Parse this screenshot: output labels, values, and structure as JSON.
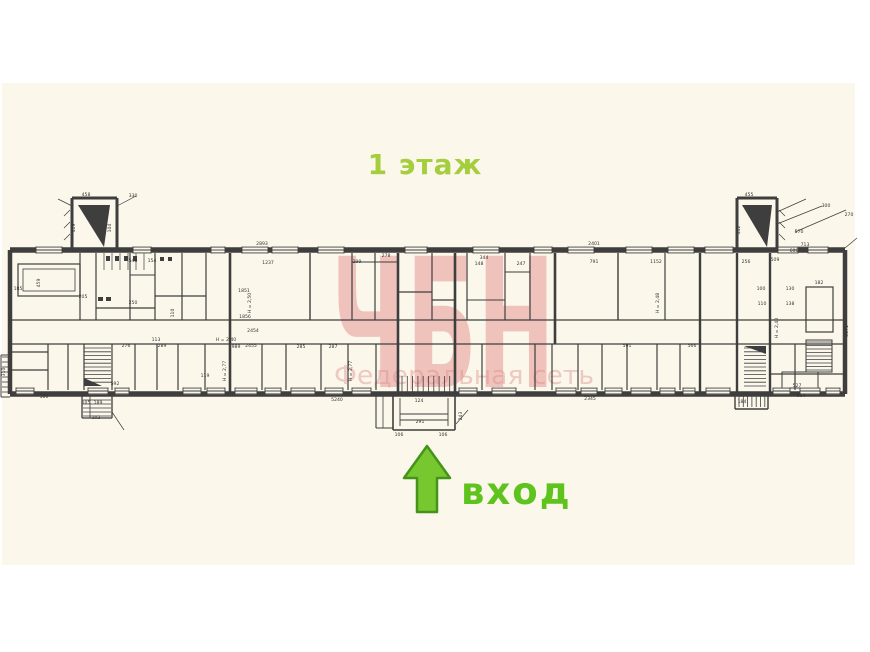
{
  "page": {
    "background": "#ffffff",
    "scan_background": "#fbf7ea",
    "line_color": "#3e3e3e"
  },
  "title": {
    "text": "1 этаж",
    "color": "#a5ce3e"
  },
  "entrance": {
    "label": "вход",
    "color": "#5fc31d",
    "arrow_fill": "#76c82e",
    "arrow_stroke": "#44941b"
  },
  "watermark": {
    "letters": "ЧБН",
    "subtitle": "Федеральная сеть",
    "color": "#e59090",
    "subtitle_color": "#de8a8a"
  },
  "plan": {
    "labels": [
      [
        "2893",
        262,
        245
      ],
      [
        "2401",
        594,
        245
      ],
      [
        "458",
        86,
        196
      ],
      [
        "419",
        75,
        228,
        1
      ],
      [
        "104",
        111,
        228,
        1
      ],
      [
        "330",
        133,
        197
      ],
      [
        "455",
        749,
        196
      ],
      [
        "442",
        740,
        230,
        1
      ],
      [
        "570",
        799,
        233
      ],
      [
        "713",
        805,
        246
      ],
      [
        "608",
        794,
        252
      ],
      [
        "300",
        826,
        207
      ],
      [
        "270",
        849,
        216
      ],
      [
        "548",
        133,
        262
      ],
      [
        "154",
        152,
        262
      ],
      [
        "459",
        40,
        283,
        1
      ],
      [
        "205",
        83,
        298
      ],
      [
        "250",
        133,
        304
      ],
      [
        "185",
        18,
        290
      ],
      [
        "1237",
        268,
        264
      ],
      [
        "299",
        357,
        263
      ],
      [
        "1851",
        244,
        292
      ],
      [
        "H = 2,50",
        251,
        303,
        1
      ],
      [
        "278",
        386,
        257
      ],
      [
        "344",
        484,
        259
      ],
      [
        "148",
        479,
        265
      ],
      [
        "247",
        521,
        265
      ],
      [
        "791",
        594,
        263
      ],
      [
        "1152",
        656,
        263
      ],
      [
        "H = 2,48",
        659,
        303,
        1
      ],
      [
        "256",
        746,
        263
      ],
      [
        "509",
        775,
        261
      ],
      [
        "182",
        819,
        284
      ],
      [
        "130",
        790,
        290
      ],
      [
        "138",
        790,
        305
      ],
      [
        "100",
        761,
        290
      ],
      [
        "110",
        762,
        305
      ],
      [
        "H = 2,40",
        778,
        328,
        1
      ],
      [
        "5671",
        848,
        331,
        1
      ],
      [
        "1856",
        245,
        318
      ],
      [
        "2454",
        253,
        332
      ],
      [
        "H = 2,40",
        226,
        341
      ],
      [
        "2455",
        251,
        347
      ],
      [
        "276",
        126,
        347
      ],
      [
        "289",
        162,
        347
      ],
      [
        "989",
        236,
        348
      ],
      [
        "285",
        301,
        348
      ],
      [
        "287",
        333,
        348
      ],
      [
        "H = 2,77",
        226,
        371,
        1
      ],
      [
        "H = 2,77",
        352,
        371,
        1
      ],
      [
        "591",
        627,
        347
      ],
      [
        "566",
        692,
        347
      ],
      [
        "105",
        86,
        404
      ],
      [
        "189",
        98,
        404
      ],
      [
        "102",
        96,
        419
      ],
      [
        "580",
        44,
        398
      ],
      [
        "110",
        174,
        313,
        1
      ],
      [
        "113",
        156,
        341
      ],
      [
        "119",
        205,
        377
      ],
      [
        "592",
        115,
        385
      ],
      [
        "310",
        5,
        372,
        1
      ],
      [
        "124",
        419,
        402
      ],
      [
        "291",
        420,
        423
      ],
      [
        "106",
        399,
        436
      ],
      [
        "106",
        443,
        436
      ],
      [
        "243",
        462,
        416,
        1
      ],
      [
        "527",
        797,
        387
      ],
      [
        "604",
        801,
        397
      ],
      [
        "184",
        742,
        403
      ],
      [
        "5240",
        337,
        401
      ],
      [
        "2345",
        590,
        400
      ]
    ]
  }
}
